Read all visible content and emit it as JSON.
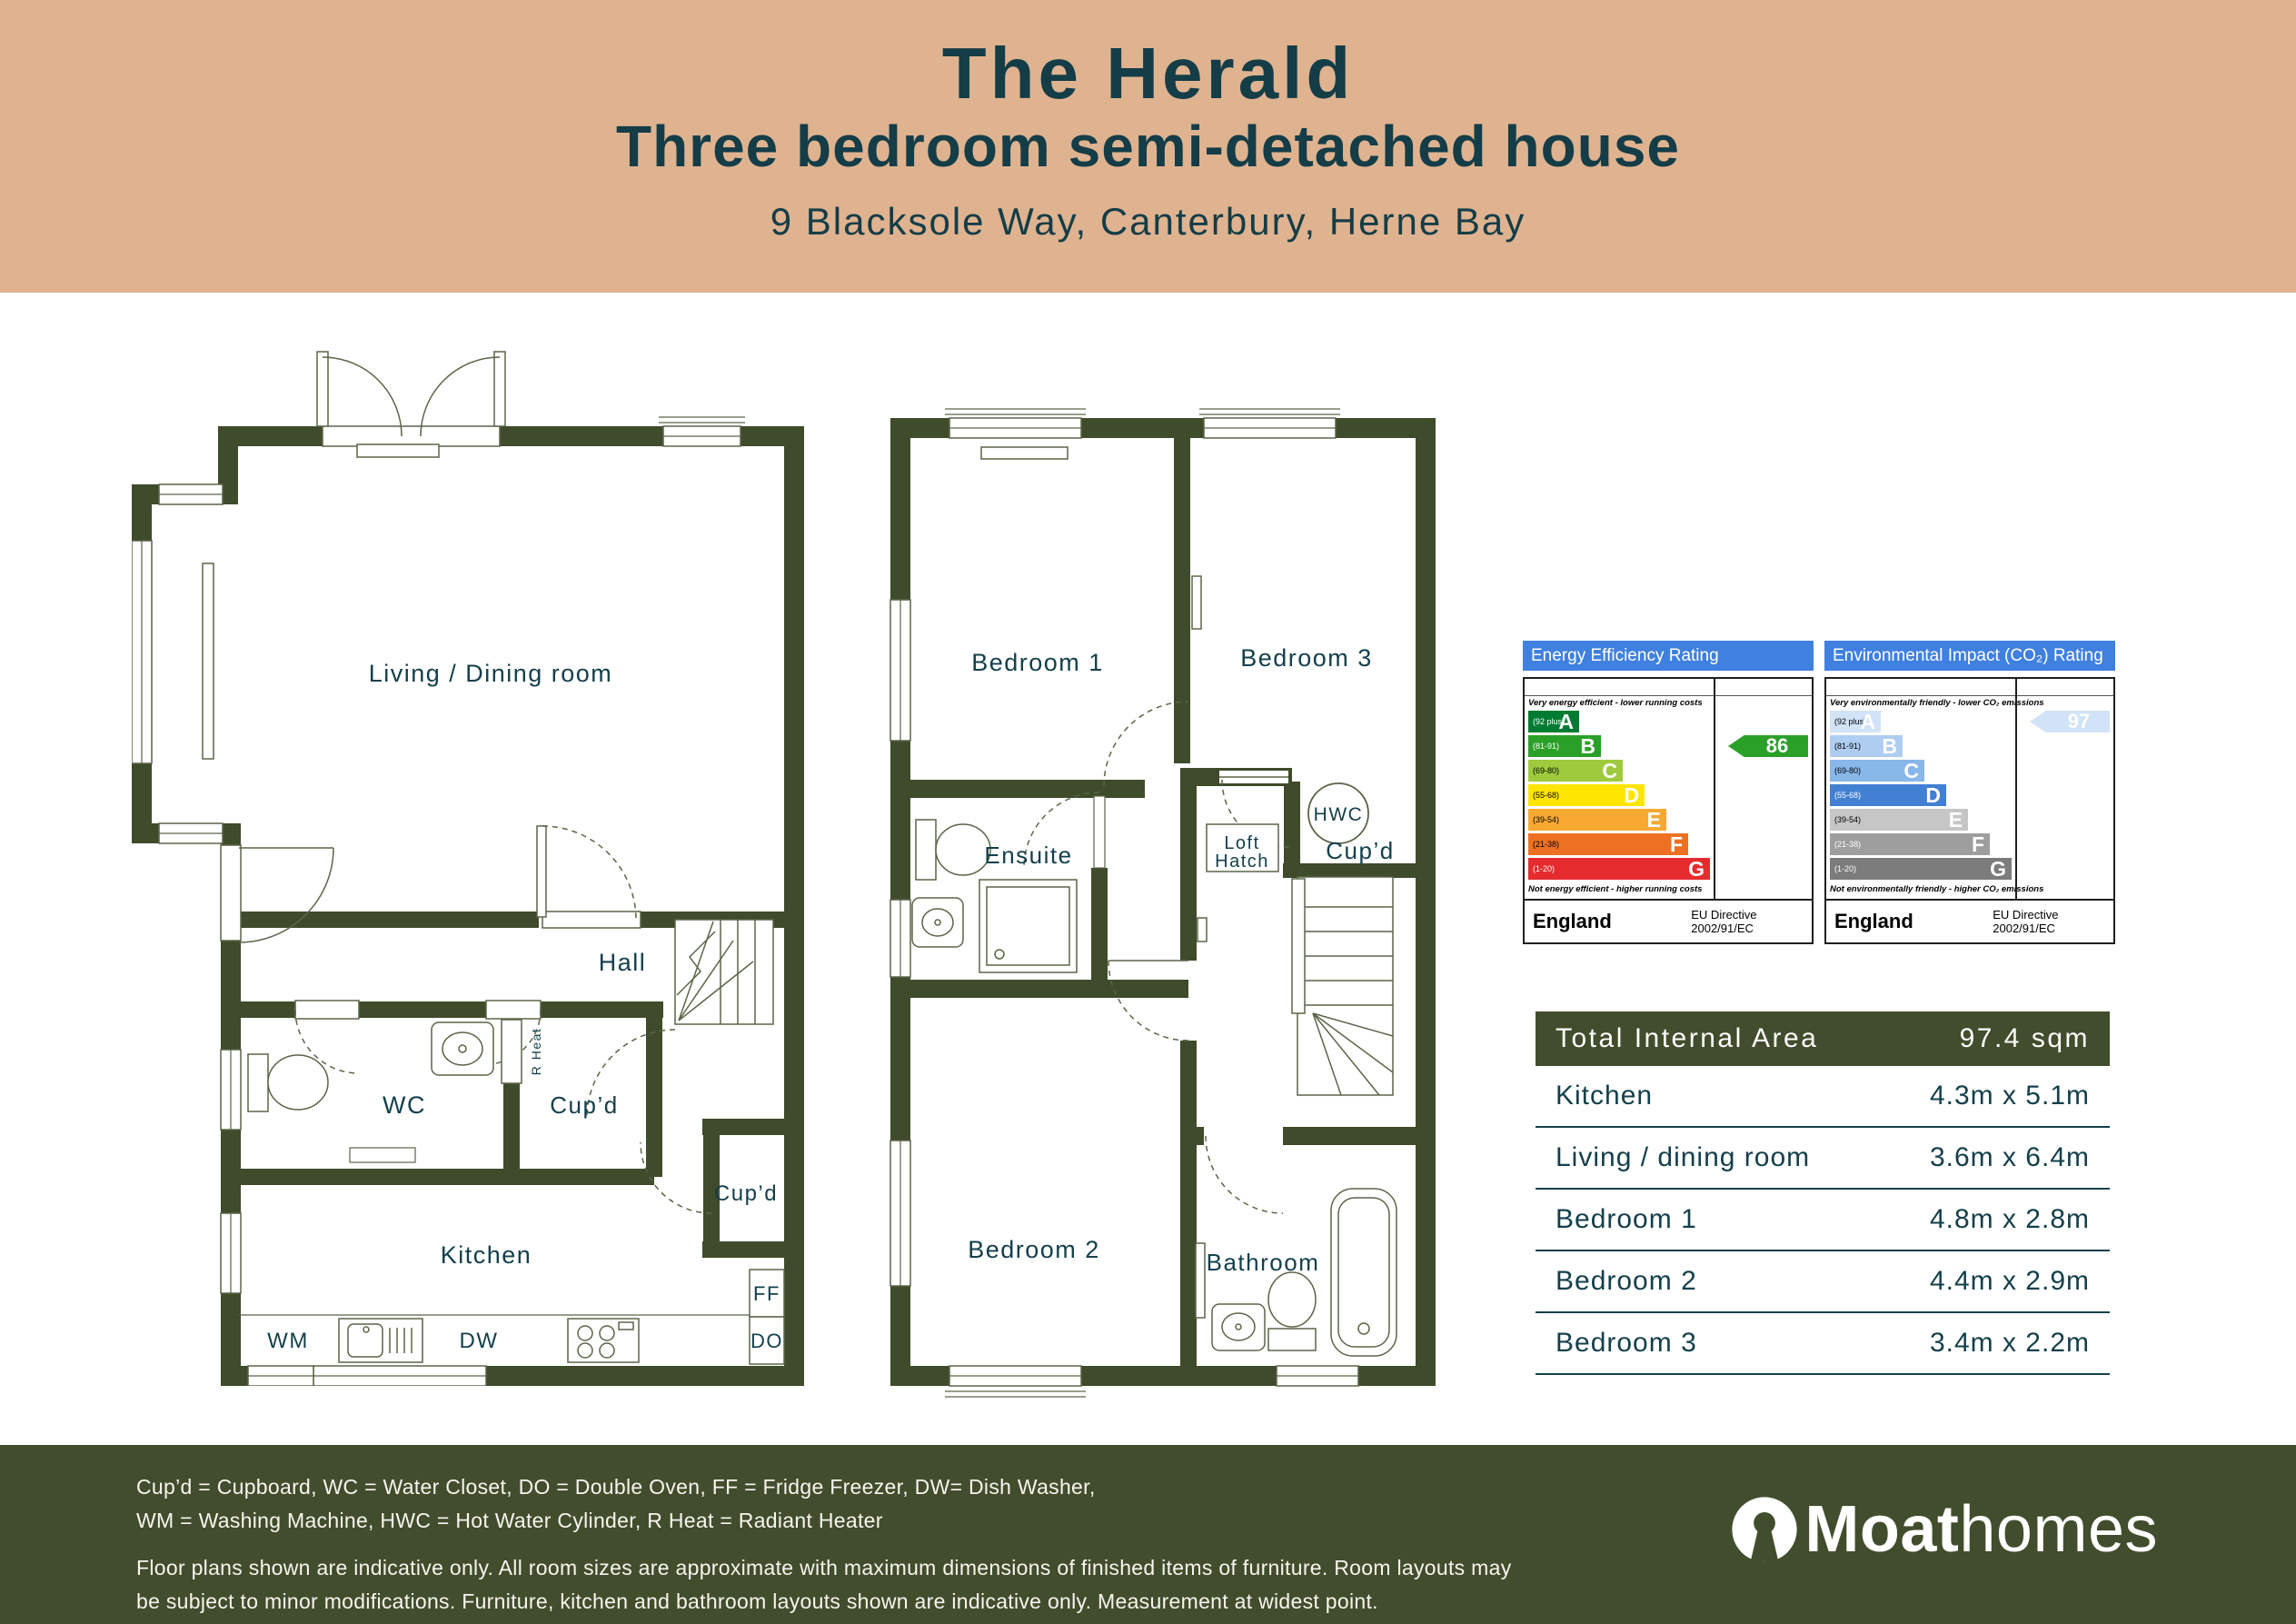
{
  "header": {
    "title": "The Herald",
    "subtitle": "Three bedroom semi-detached house",
    "address": "9 Blacksole Way, Canterbury, Herne Bay"
  },
  "plans": {
    "ground": {
      "living": "Living / Dining room",
      "hall": "Hall",
      "wc": "WC",
      "cupboard_1": "Cup’d",
      "cupboard_2": "Cup’d",
      "r_heat": "R Heat",
      "kitchen": "Kitchen",
      "ff": "FF",
      "do": "DO",
      "wm": "WM",
      "dw": "DW"
    },
    "first": {
      "bedroom1": "Bedroom 1",
      "bedroom3": "Bedroom 3",
      "ensuite": "Ensuite",
      "hwc": "HWC",
      "loft_line1": "Loft",
      "loft_line2": "Hatch",
      "cupboard": "Cup’d",
      "bedroom2": "Bedroom 2",
      "bathroom": "Bathroom"
    }
  },
  "epc": {
    "energy": {
      "title": "Energy Efficiency Rating",
      "note_top": "Very energy efficient - lower running costs",
      "note_bottom": "Not energy efficient - higher running costs",
      "bands": [
        {
          "letter": "A",
          "range": "(92 plus)",
          "color": "#007b33",
          "range_color": "#ffffff"
        },
        {
          "letter": "B",
          "range": "(81-91)",
          "color": "#2ba029",
          "range_color": "#ffffff"
        },
        {
          "letter": "C",
          "range": "(69-80)",
          "color": "#9ecb3d",
          "range_color": "#000000"
        },
        {
          "letter": "D",
          "range": "(55-68)",
          "color": "#ffe500",
          "range_color": "#000000"
        },
        {
          "letter": "E",
          "range": "(39-54)",
          "color": "#f8a932",
          "range_color": "#000000"
        },
        {
          "letter": "F",
          "range": "(21-38)",
          "color": "#ee7023",
          "range_color": "#000000"
        },
        {
          "letter": "G",
          "range": "(1-20)",
          "color": "#e52b2e",
          "range_color": "#ffffff"
        }
      ],
      "rating": {
        "value": "86",
        "band_index": 1,
        "color": "#2ba029",
        "text_color": "#ffffff"
      },
      "footer_country": "England",
      "directive1": "EU Directive",
      "directive2": "2002/91/EC"
    },
    "environmental": {
      "title": "Environmental Impact (CO₂) Rating",
      "note_top": "Very environmentally friendly - lower CO₂ emissions",
      "note_bottom": "Not environmentally friendly - higher CO₂ emissions",
      "bands": [
        {
          "letter": "A",
          "range": "(92 plus)",
          "color": "#d1e3f7",
          "range_color": "#000000"
        },
        {
          "letter": "B",
          "range": "(81-91)",
          "color": "#aecdf1",
          "range_color": "#000000"
        },
        {
          "letter": "C",
          "range": "(69-80)",
          "color": "#88b7ea",
          "range_color": "#000000"
        },
        {
          "letter": "D",
          "range": "(55-68)",
          "color": "#4180d3",
          "range_color": "#ffffff"
        },
        {
          "letter": "E",
          "range": "(39-54)",
          "color": "#c6c6c6",
          "range_color": "#000000"
        },
        {
          "letter": "F",
          "range": "(21-38)",
          "color": "#9e9e9e",
          "range_color": "#ffffff"
        },
        {
          "letter": "G",
          "range": "(1-20)",
          "color": "#7c7c7c",
          "range_color": "#ffffff"
        }
      ],
      "rating": {
        "value": "97",
        "band_index": 0,
        "color": "#d1e3f7",
        "text_color": "#ffffff"
      },
      "footer_country": "England",
      "directive1": "EU Directive",
      "directive2": "2002/91/EC"
    }
  },
  "dimensions": {
    "header_label": "Total Internal Area",
    "header_value": "97.4 sqm",
    "rows": [
      {
        "label": "Kitchen",
        "value": "4.3m x 5.1m"
      },
      {
        "label": "Living / dining room",
        "value": "3.6m x 6.4m"
      },
      {
        "label": "Bedroom 1",
        "value": "4.8m x 2.8m"
      },
      {
        "label": "Bedroom 2",
        "value": "4.4m x 2.9m"
      },
      {
        "label": "Bedroom 3",
        "value": "3.4m x 2.2m"
      }
    ]
  },
  "footer": {
    "legend_line1": "Cup’d = Cupboard, WC = Water Closet, DO = Double Oven, FF = Fridge Freezer, DW= Dish Washer,",
    "legend_line2": "WM = Washing Machine, HWC = Hot Water Cylinder, R Heat = Radiant Heater",
    "disclaimer_line1": "Floor plans shown are indicative only. All room sizes are approximate with maximum dimensions of finished items of furniture. Room layouts may",
    "disclaimer_line2": "be subject to minor modifications. Furniture, kitchen and bathroom layouts shown are indicative only. Measurement at widest point.",
    "brand_bold": "Moat",
    "brand_light": "homes"
  },
  "colors": {
    "header_beige": "#dfb390",
    "wall_green": "#3f4b2a",
    "footer_green": "#414d2c",
    "teal_text": "#14404b",
    "epc_blue": "#3f80e0"
  }
}
